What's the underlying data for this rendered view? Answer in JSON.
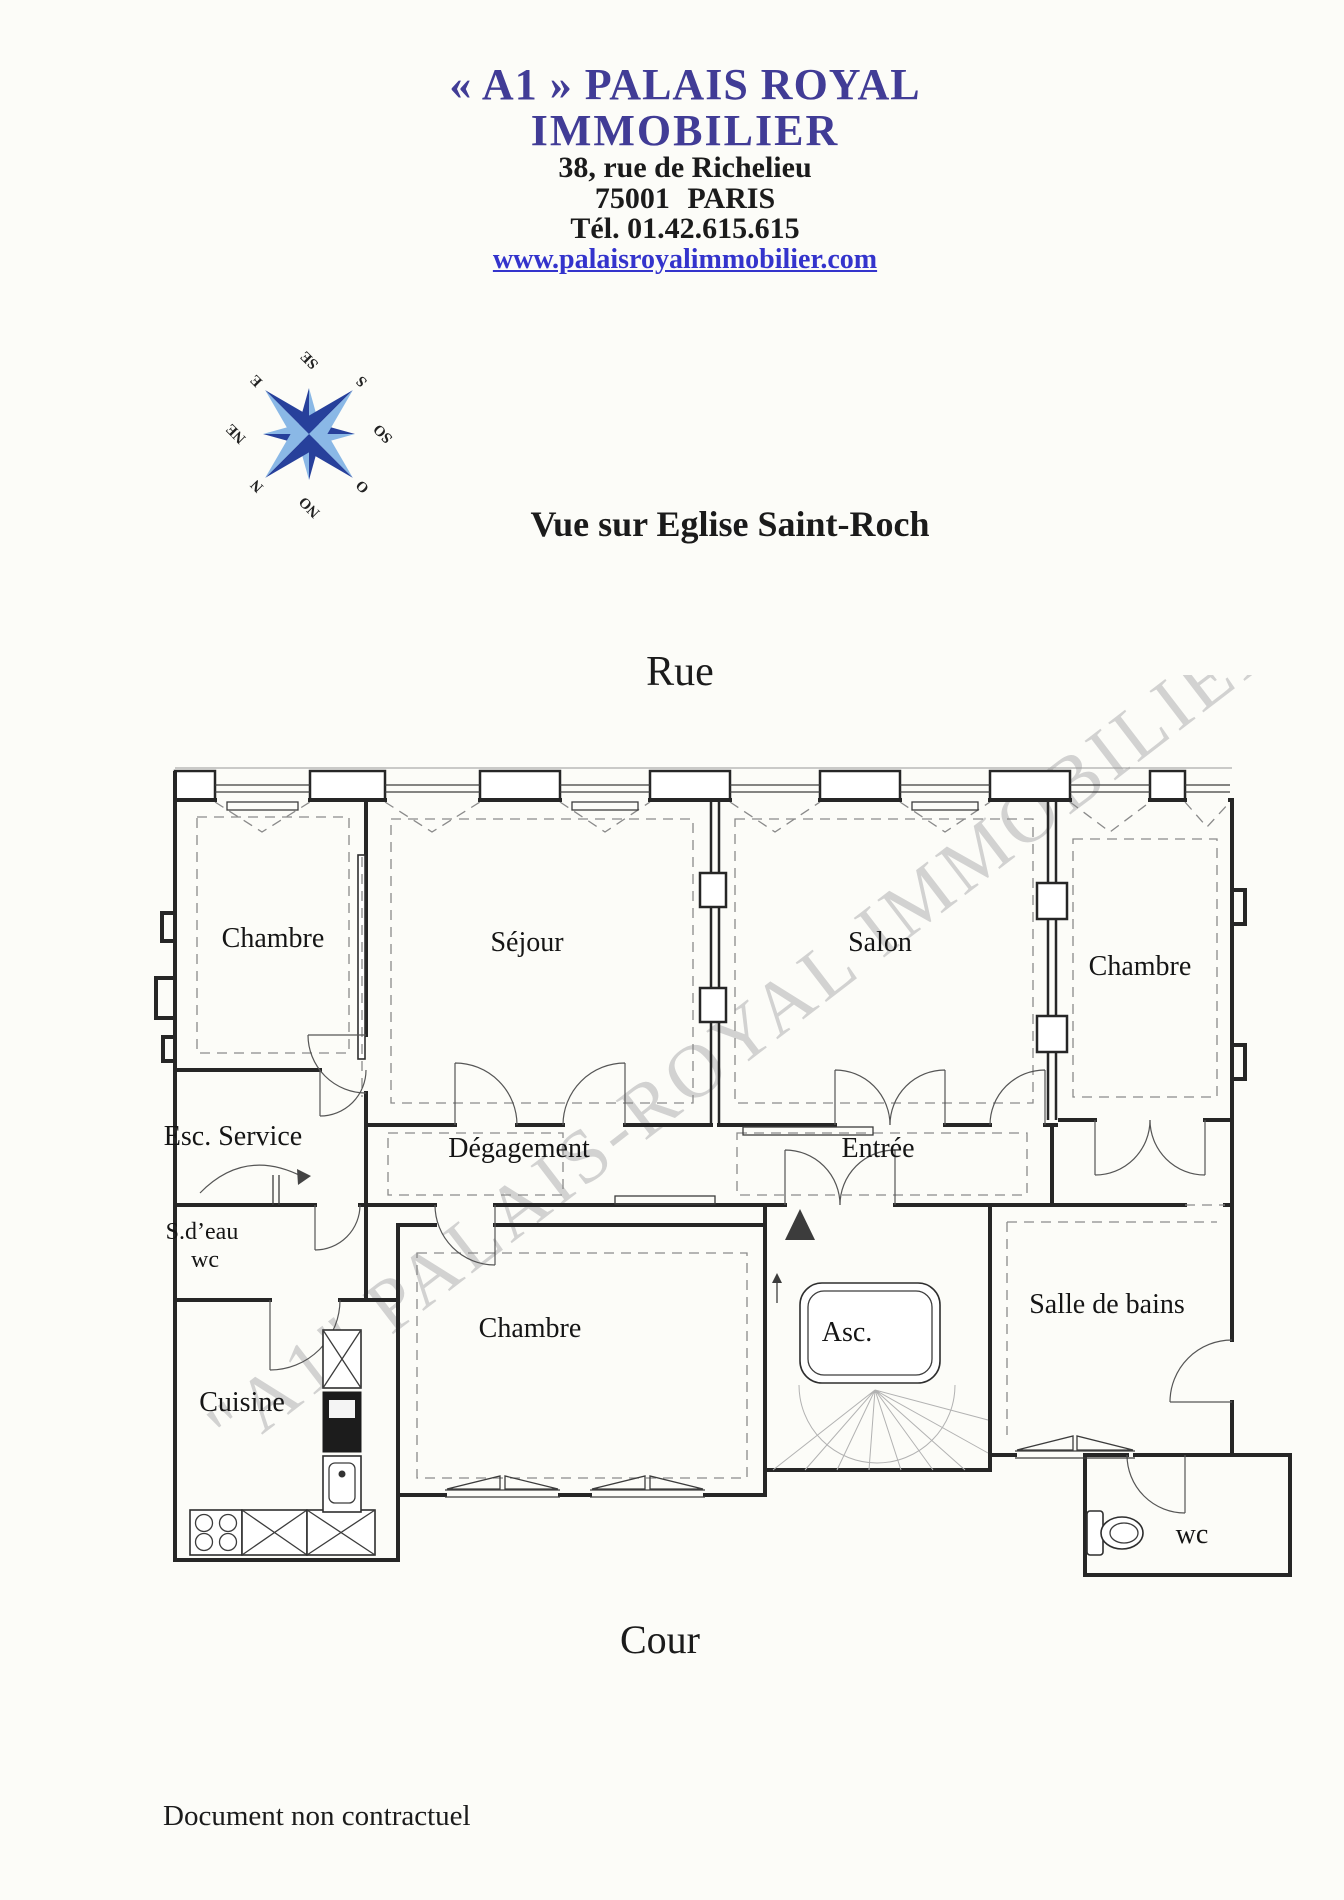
{
  "page": {
    "background_color": "#fcfcf8",
    "footer_disclaimer": "Document non contractuel"
  },
  "header": {
    "agency_line1": "« A1 » PALAIS ROYAL",
    "agency_line2": "IMMOBILIER",
    "address_street": "38, rue de Richelieu",
    "address_city": "75001  PARIS",
    "phone": "Tél. 01.42.615.615",
    "website": "www.palaisroyalimmobilier.com",
    "brand_color": "#413c96",
    "link_color": "#3434cc"
  },
  "view_note": "Vue sur Eglise Saint-Roch",
  "orientation": {
    "street_side": "Rue",
    "courtyard_side": "Cour"
  },
  "compass": {
    "points": [
      "N",
      "NE",
      "E",
      "SE",
      "S",
      "SO",
      "O",
      "NO"
    ],
    "rotation_deg": 225,
    "dark_color": "#27409b",
    "light_color": "#8ab8e6"
  },
  "floor_plan": {
    "watermark": "\"A1\" PALAIS-ROYAL IMMOBILIER",
    "elevator_note": "elevator and main stair at courtyard side",
    "rooms": [
      {
        "id": "chambre-nw",
        "label": "Chambre"
      },
      {
        "id": "sejour",
        "label": "Séjour"
      },
      {
        "id": "salon",
        "label": "Salon"
      },
      {
        "id": "chambre-ne",
        "label": "Chambre"
      },
      {
        "id": "esc-service",
        "label": "Esc. Service"
      },
      {
        "id": "degagement",
        "label": "Dégagement"
      },
      {
        "id": "entree",
        "label": "Entrée"
      },
      {
        "id": "sdeau",
        "label": "S.d’eau"
      },
      {
        "id": "sdeau-wc",
        "label": "wc"
      },
      {
        "id": "cuisine",
        "label": "Cuisine"
      },
      {
        "id": "chambre-s",
        "label": "Chambre"
      },
      {
        "id": "ascenseur",
        "label": "Asc."
      },
      {
        "id": "salle-de-bains",
        "label": "Salle de bains"
      },
      {
        "id": "wc",
        "label": "wc"
      }
    ]
  }
}
